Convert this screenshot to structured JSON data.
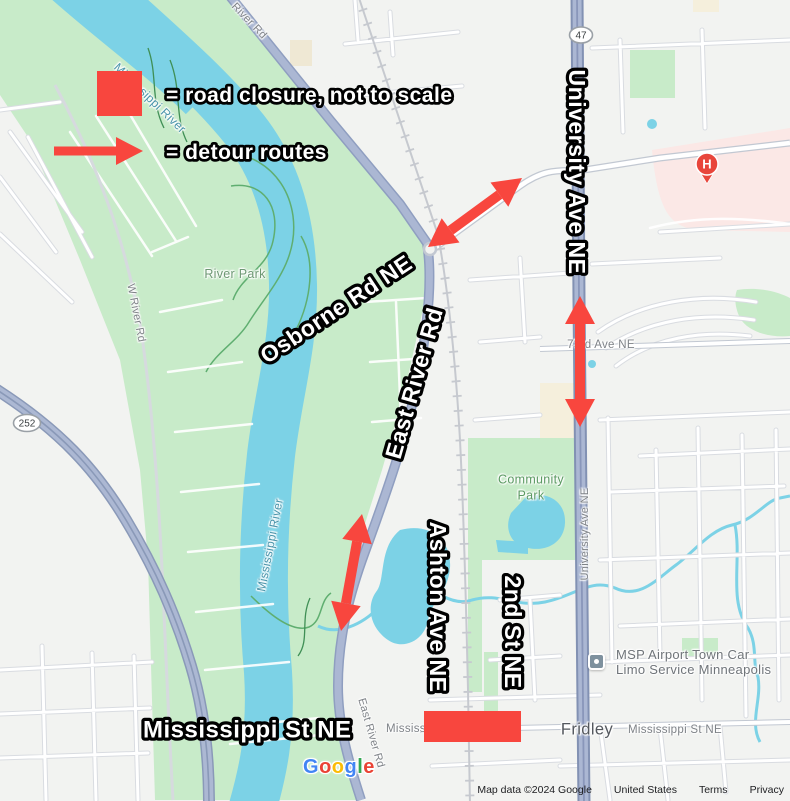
{
  "colors": {
    "annotation_red": "#f8463e",
    "water_blue": "#7cd2e6",
    "park_green": "#c8ebc9",
    "road_major_fill": "#abb7d3",
    "hospital_pink": "#fbe8e6"
  },
  "legend": {
    "closure_text": "= road closure, not to scale",
    "detour_text": "= detour routes"
  },
  "road_annotations": {
    "osborne": "Osborne Rd NE",
    "east_river": "East River Rd",
    "university": "University Ave NE",
    "ashton": "Ashton Ave NE",
    "second_st": "2nd St NE",
    "mississippi_st": "Mississippi St NE"
  },
  "map_labels": {
    "river_rd_top": "River Rd",
    "mississippi_river_top": "Mississippi River",
    "mississippi_river_mid": "Mississippi River",
    "w_river_rd": "W River Rd",
    "river_park": "River Park",
    "community_park": "Community Park",
    "seventy_third_ave": "73rd Ave NE",
    "university_ave_small": "University Ave NE",
    "east_river_rd_small": "East River Rd",
    "mississippi_st_left": "Mississippi St NE",
    "mississippi_st_right": "Mississippi St NE",
    "fridley": "Fridley",
    "msp_line1": "MSP Airport Town Car",
    "msp_line2": "Limo Service Minneapolis",
    "highway_47": "47",
    "highway_252": "252",
    "hospital_marker": "H"
  },
  "google_logo": {
    "letters": [
      {
        "ch": "G",
        "color": "#4285F4"
      },
      {
        "ch": "o",
        "color": "#EA4335"
      },
      {
        "ch": "o",
        "color": "#FBBC05"
      },
      {
        "ch": "g",
        "color": "#4285F4"
      },
      {
        "ch": "l",
        "color": "#34A853"
      },
      {
        "ch": "e",
        "color": "#EA4335"
      }
    ]
  },
  "attribution": {
    "map_data": "Map data ©2024 Google",
    "region": "United States",
    "terms": "Terms",
    "privacy": "Privacy"
  }
}
